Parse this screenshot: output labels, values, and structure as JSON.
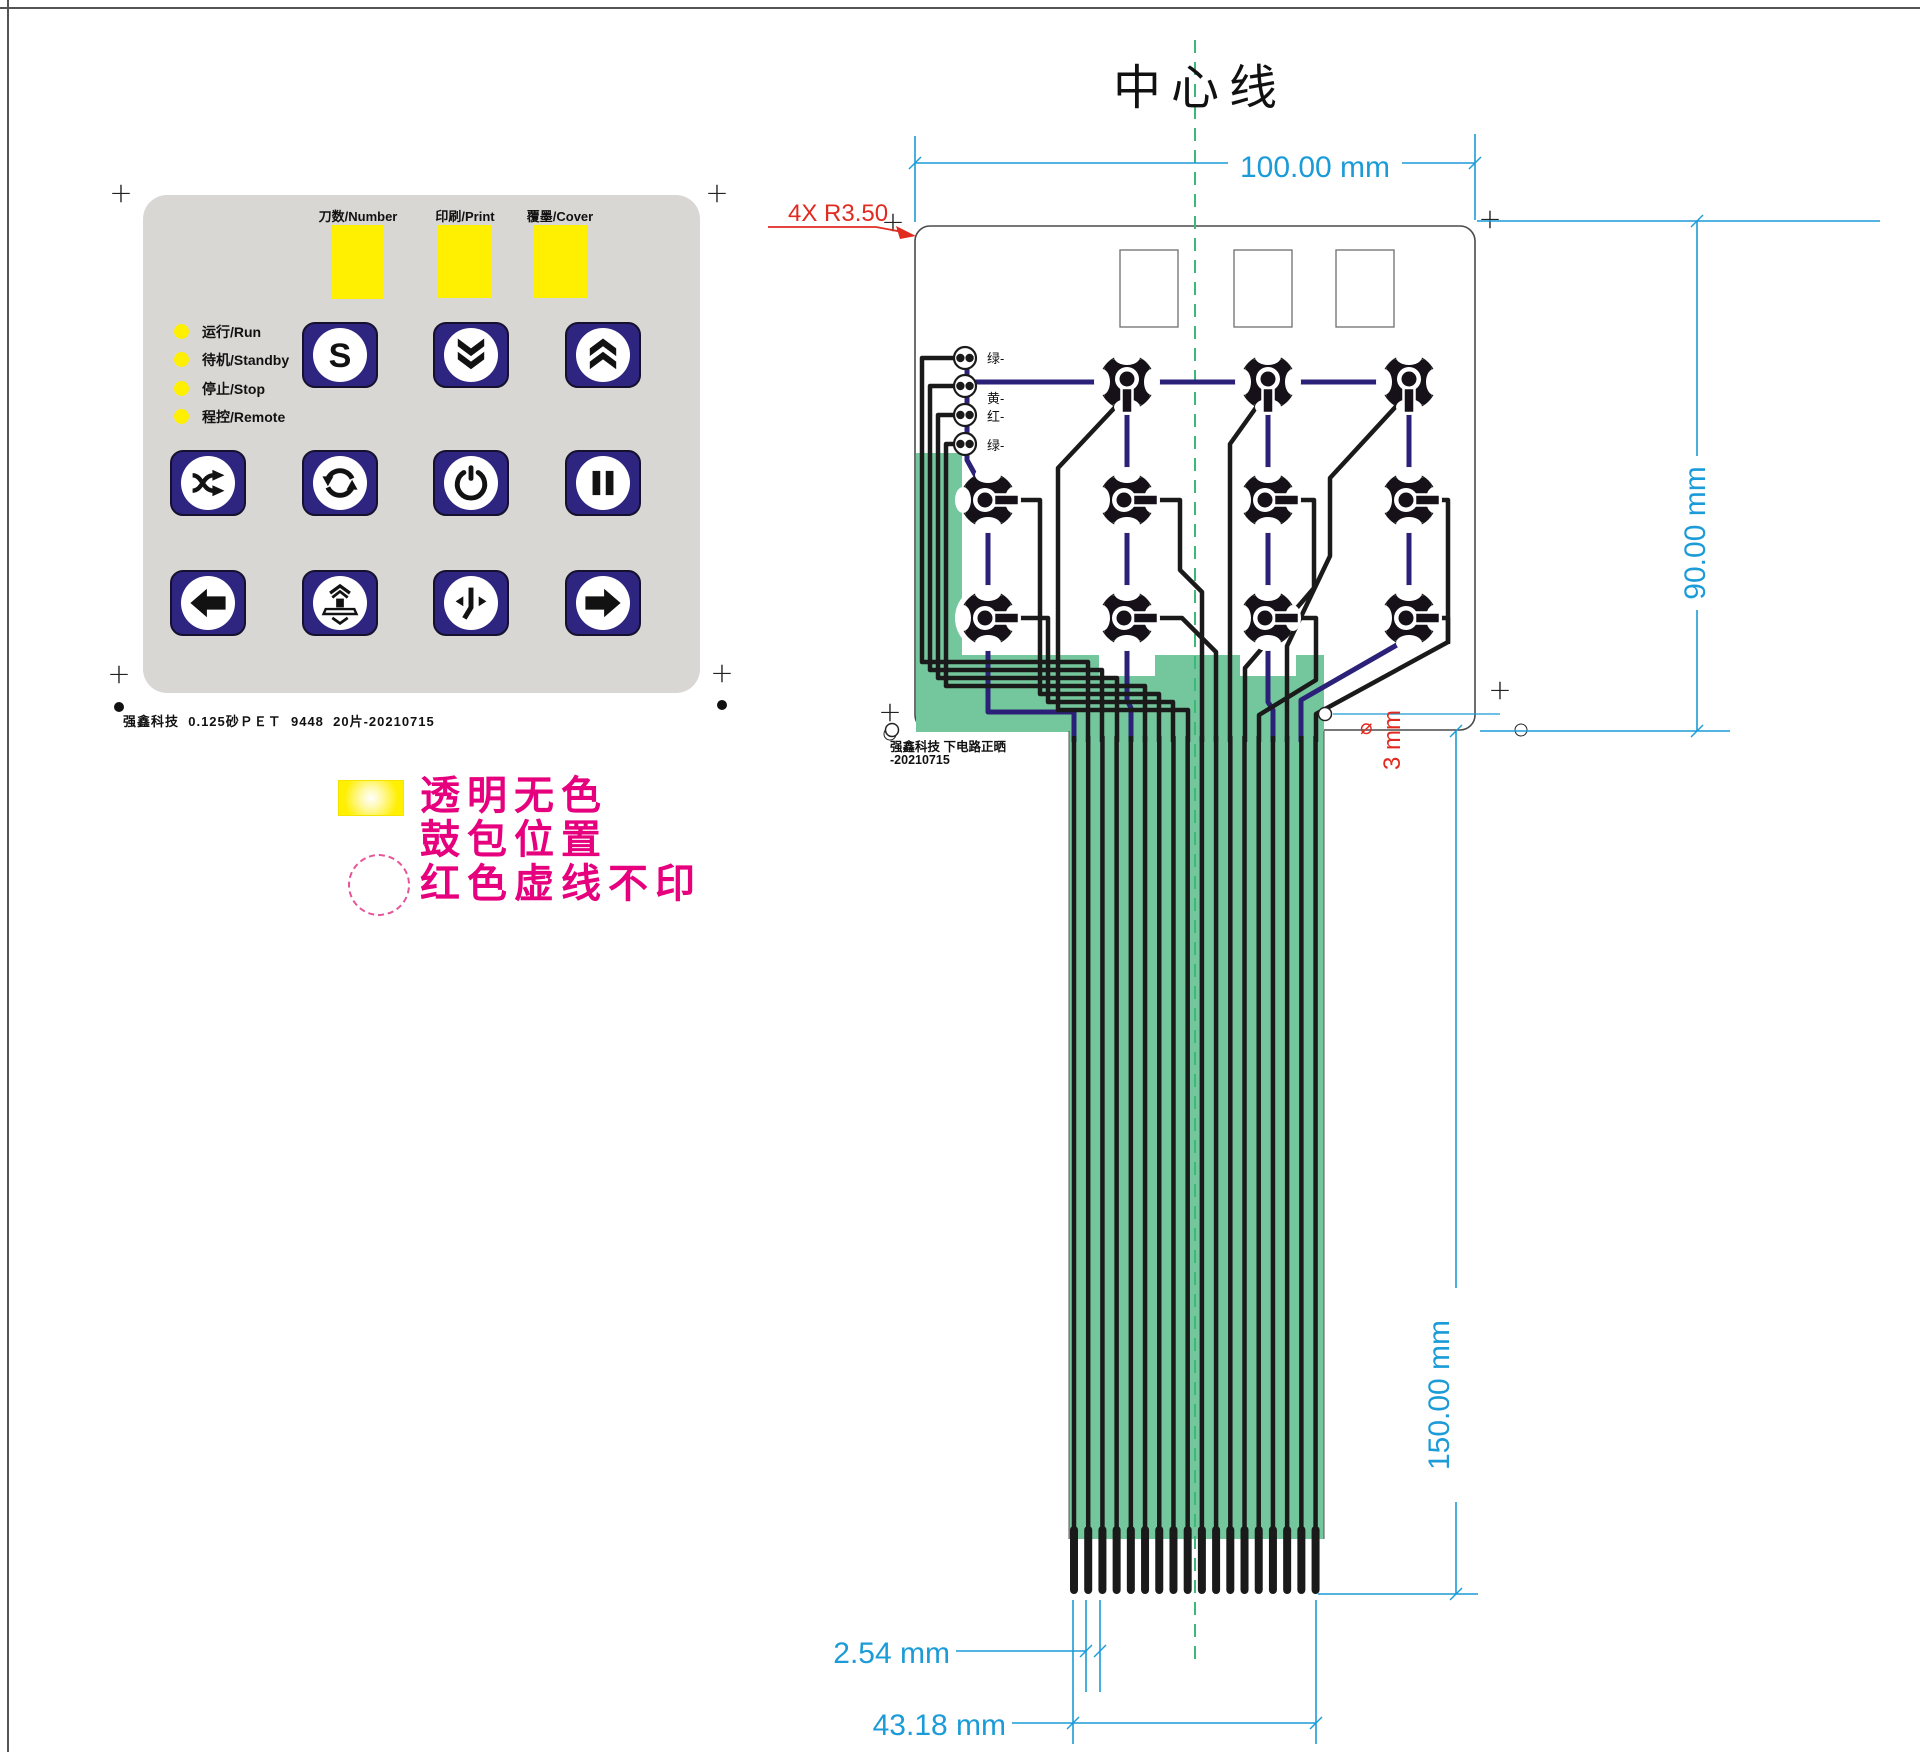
{
  "frame": {
    "centerline_title": "中心线"
  },
  "panel": {
    "window_labels": [
      "刀数/Number",
      "印刷/Print",
      "覆墨/Cover"
    ],
    "status_labels": [
      "运行/Run",
      "待机/Standby",
      "停止/Stop",
      "程控/Remote"
    ],
    "buttons": [
      "s",
      "double-chevron-down",
      "double-chevron-up",
      "shuffle",
      "cycle",
      "power",
      "pause",
      "arrow-left",
      "press-platen",
      "up-down",
      "arrow-right"
    ],
    "caption": "强鑫科技  0.125砂ＰＥＴ  9448  20片-20210715"
  },
  "legend": {
    "line1": "透明无色",
    "line2": "鼓包位置",
    "line3": "红色虚线不印"
  },
  "circuit": {
    "radius_callout": "4X R3.50",
    "led_labels": [
      "绿-",
      "黄-",
      "红-",
      "绿-"
    ],
    "caption_line1": "强鑫科技  下电路正晒",
    "caption_line2": "-20210715",
    "hole_diameter_symbol": "⌀",
    "hole_diameter": "3 mm"
  },
  "dimensions": {
    "board_width": "100.00 mm",
    "board_height": "90.00 mm",
    "tail_length": "150.00 mm",
    "finger_pitch": "2.54 mm",
    "tail_width": "43.18 mm"
  },
  "colors": {
    "panel_gray": "#d8d7d4",
    "button_navy": "#2e2580",
    "window_yellow": "#ffef00",
    "legend_pink": "#e6007e",
    "dimension_blue": "#1b9bd7",
    "callout_red": "#e02b20",
    "trace_navy": "#2b2178",
    "tail_green": "#74c79c",
    "centerline_green": "#3cb878"
  }
}
